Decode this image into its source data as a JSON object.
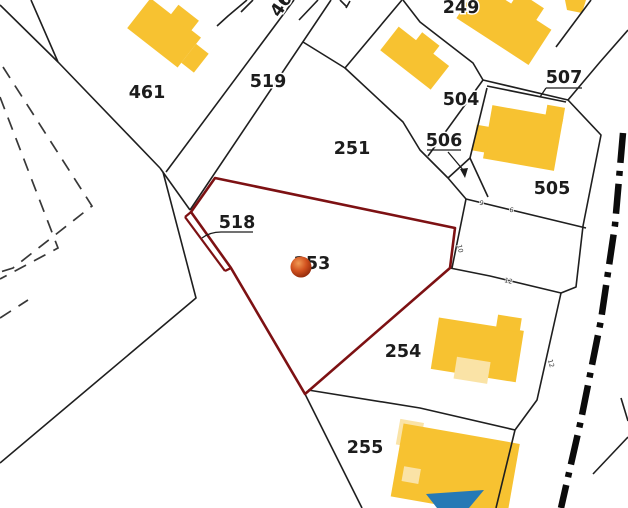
{
  "map": {
    "type": "cadastral-parcel-map",
    "selected_parcel": "253",
    "colors": {
      "background": "#ffffff",
      "boundary": "#1f1f1f",
      "highlight": "#7d1113",
      "building": "#f7c231",
      "building_annex": "#fae3a6",
      "pool": "#2579b5",
      "marker_center": "#f09a55",
      "marker_mid": "#d2521f",
      "marker_edge": "#8a2508"
    },
    "parcel_labels": [
      {
        "id": "461",
        "text": "461"
      },
      {
        "id": "46",
        "text": "46"
      },
      {
        "id": "519",
        "text": "519"
      },
      {
        "id": "251",
        "text": "251"
      },
      {
        "id": "249",
        "text": "249"
      },
      {
        "id": "504",
        "text": "504"
      },
      {
        "id": "507",
        "text": "507"
      },
      {
        "id": "506",
        "text": "506"
      },
      {
        "id": "505",
        "text": "505"
      },
      {
        "id": "518",
        "text": "518"
      },
      {
        "id": "253",
        "text": "253"
      },
      {
        "id": "254",
        "text": "254"
      },
      {
        "id": "255",
        "text": "255"
      }
    ],
    "dimension_labels": [
      {
        "text": "9"
      },
      {
        "text": "6"
      },
      {
        "text": "10"
      },
      {
        "text": "12"
      },
      {
        "text": "12"
      }
    ],
    "marker": {
      "parcel": "253"
    }
  }
}
